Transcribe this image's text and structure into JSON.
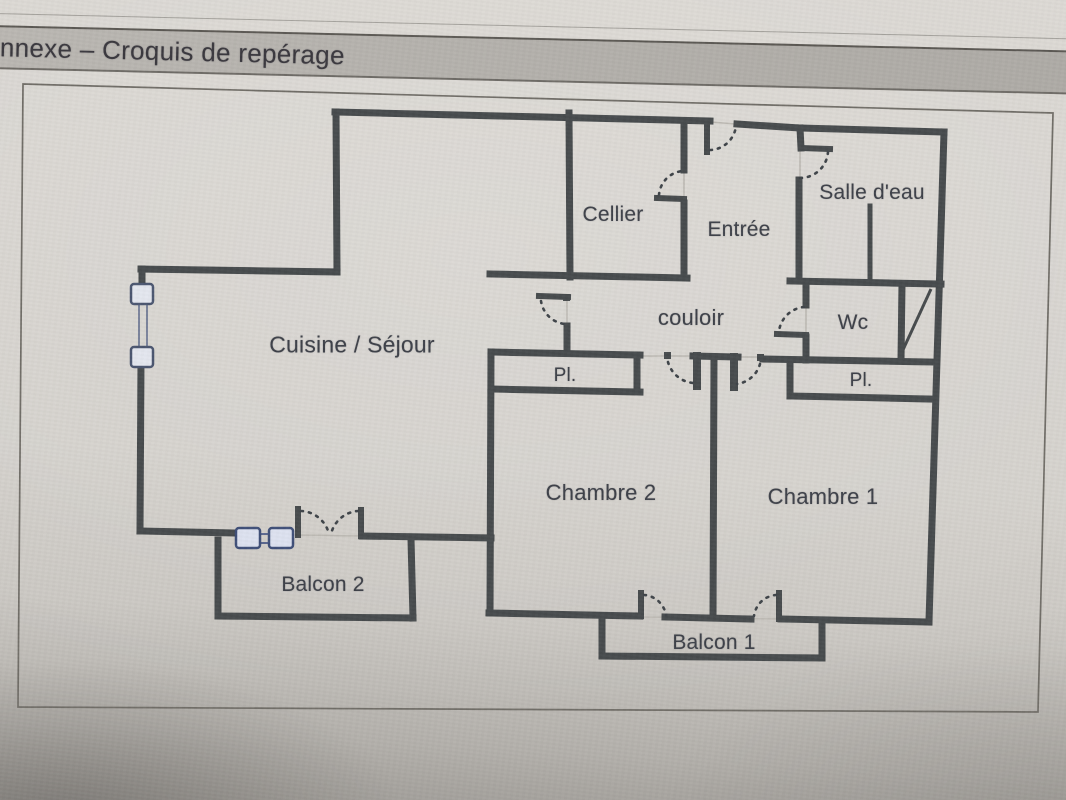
{
  "header": {
    "title": "nnexe – Croquis de repérage"
  },
  "plan": {
    "rooms": {
      "cellier": "Cellier",
      "entree": "Entrée",
      "salle_deau": "Salle d'eau",
      "couloir": "couloir",
      "wc": "Wc",
      "placard_couloir": "Pl.",
      "placard_chambre1": "Pl.",
      "cuisine_sejour": "Cuisine / Séjour",
      "chambre2": "Chambre 2",
      "chambre1": "Chambre 1",
      "balcon2": "Balcon 2",
      "balcon1": "Balcon 1"
    },
    "colors": {
      "wall": "#474b4d",
      "label_text": "#3e4149",
      "window_fill": "#e4e7ef",
      "window_border": "#4b5670",
      "header_bar": "#b3b0ab",
      "header_text": "#3a383e",
      "paper": "#d7d4cf"
    }
  }
}
